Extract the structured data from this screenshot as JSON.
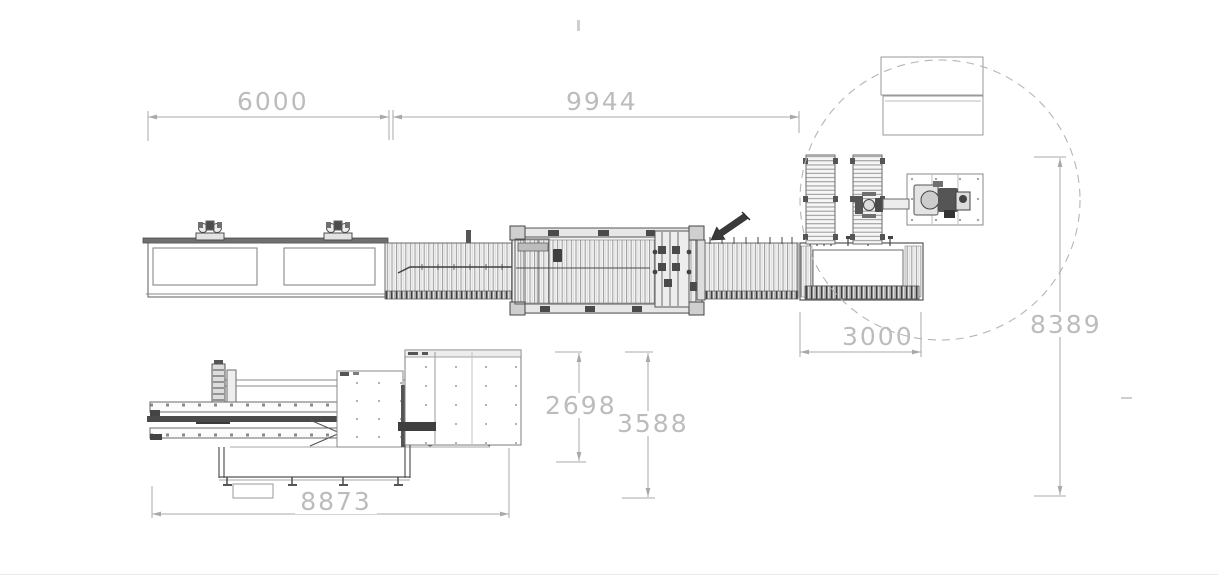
{
  "drawing": {
    "title": "production-line-layout-plan",
    "dimensions": {
      "infeed_length": "6000",
      "main_line_length": "9944",
      "outfeed_width": "3000",
      "cell_height": "8389",
      "stacker_inner_height": "2698",
      "stacker_outer_height": "3588",
      "stacker_length": "8873"
    },
    "colors": {
      "background": "#ffffff",
      "dimension_line": "#a9a9a9",
      "dimension_text": "#bcbcbc",
      "machine_line": "#5f5f5f",
      "machine_dark": "#3f3f3f",
      "detail_circle": "#b5b5b5"
    }
  }
}
